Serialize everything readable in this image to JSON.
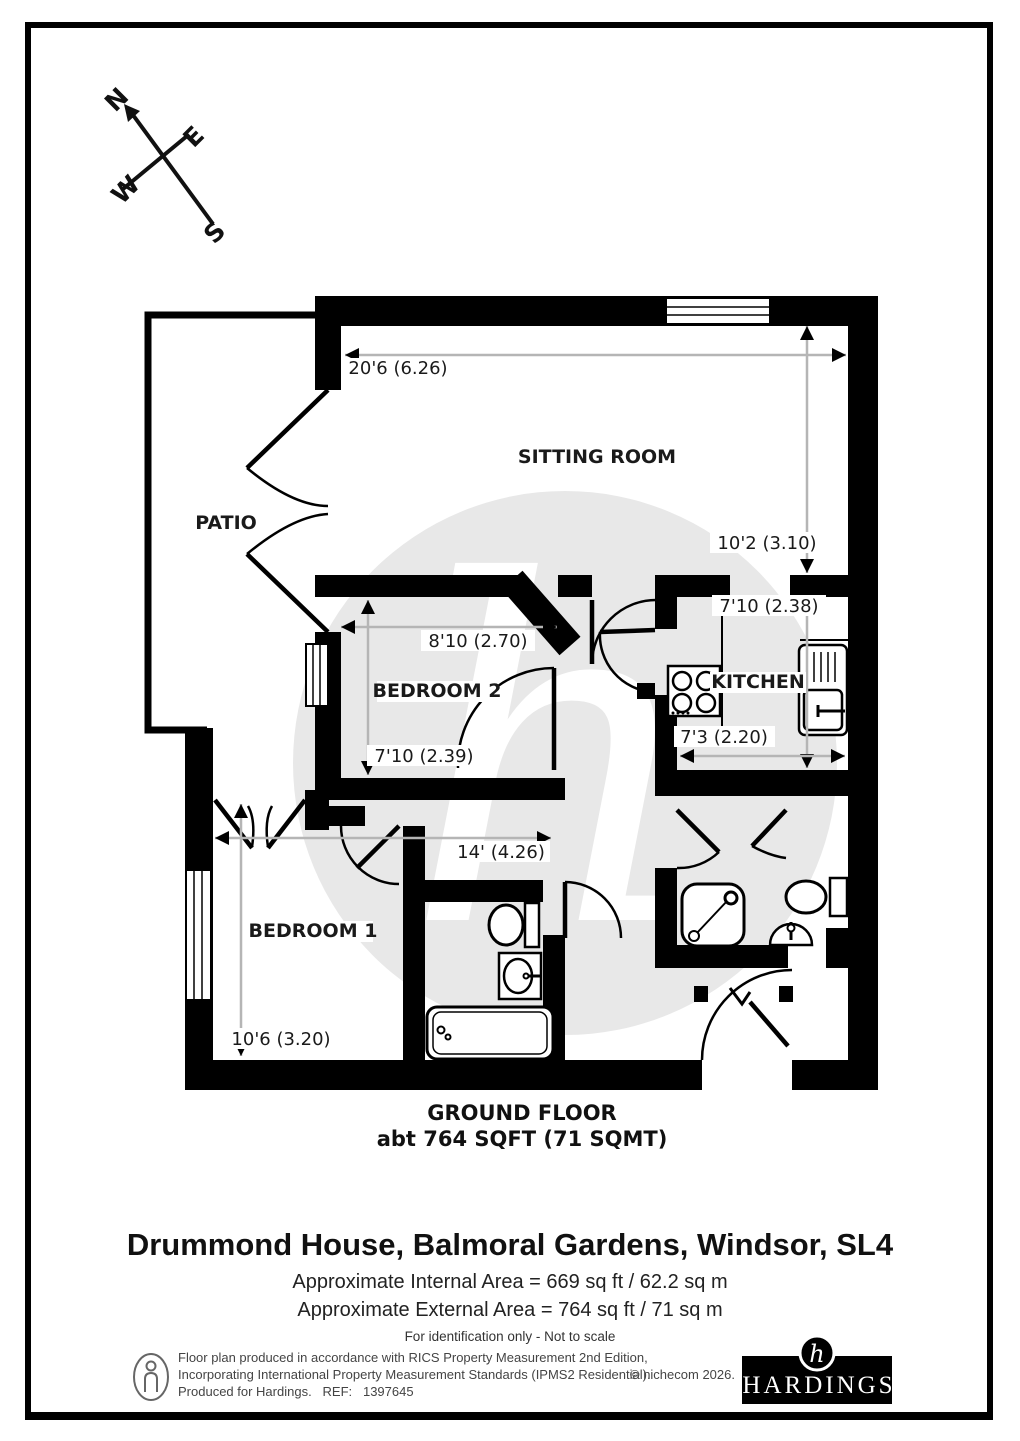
{
  "compass": {
    "north": "N",
    "east": "E",
    "west": "W",
    "south": "S"
  },
  "watermark_letter": "h",
  "rooms": {
    "patio": "PATIO",
    "sitting_room": "SITTING ROOM",
    "bedroom2": "BEDROOM 2",
    "kitchen": "KITCHEN",
    "bedroom1": "BEDROOM 1"
  },
  "dims": {
    "sitting_width": "20'6 (6.26)",
    "sitting_depth": "10'2 (3.10)",
    "kitchen_depth": "7'10 (2.38)",
    "bedroom2_width": "8'10 (2.70)",
    "bedroom2_depth": "7'10 (2.39)",
    "kitchen_width": "7'3 (2.20)",
    "bedroom1_width": "14' (4.26)",
    "bedroom1_depth": "10'6 (3.20)"
  },
  "floor": {
    "name": "GROUND FLOOR",
    "area": "abt 764 SQFT (71 SQMT)"
  },
  "title": {
    "address": "Drummond House, Balmoral Gardens, Windsor, SL4",
    "internal": "Approximate Internal Area = 669 sq ft / 62.2 sq m",
    "external": "Approximate External Area = 764 sq ft / 71 sq m",
    "disclaimer": "For identification only - Not to scale"
  },
  "footer": {
    "line1": "Floor plan produced in accordance with RICS Property Measurement 2nd Edition,",
    "line2": "Incorporating International Property Measurement Standards (IPMS2 Residential).",
    "line3": "Produced for Hardings.   REF:   1397645",
    "copyright": "© nichecom 2026.",
    "brand": "HARDINGS",
    "brand_monogram": "h"
  },
  "colors": {
    "wall": "#000000",
    "watermark": "#e8e8e8",
    "dim_line": "#b5b5b5"
  }
}
